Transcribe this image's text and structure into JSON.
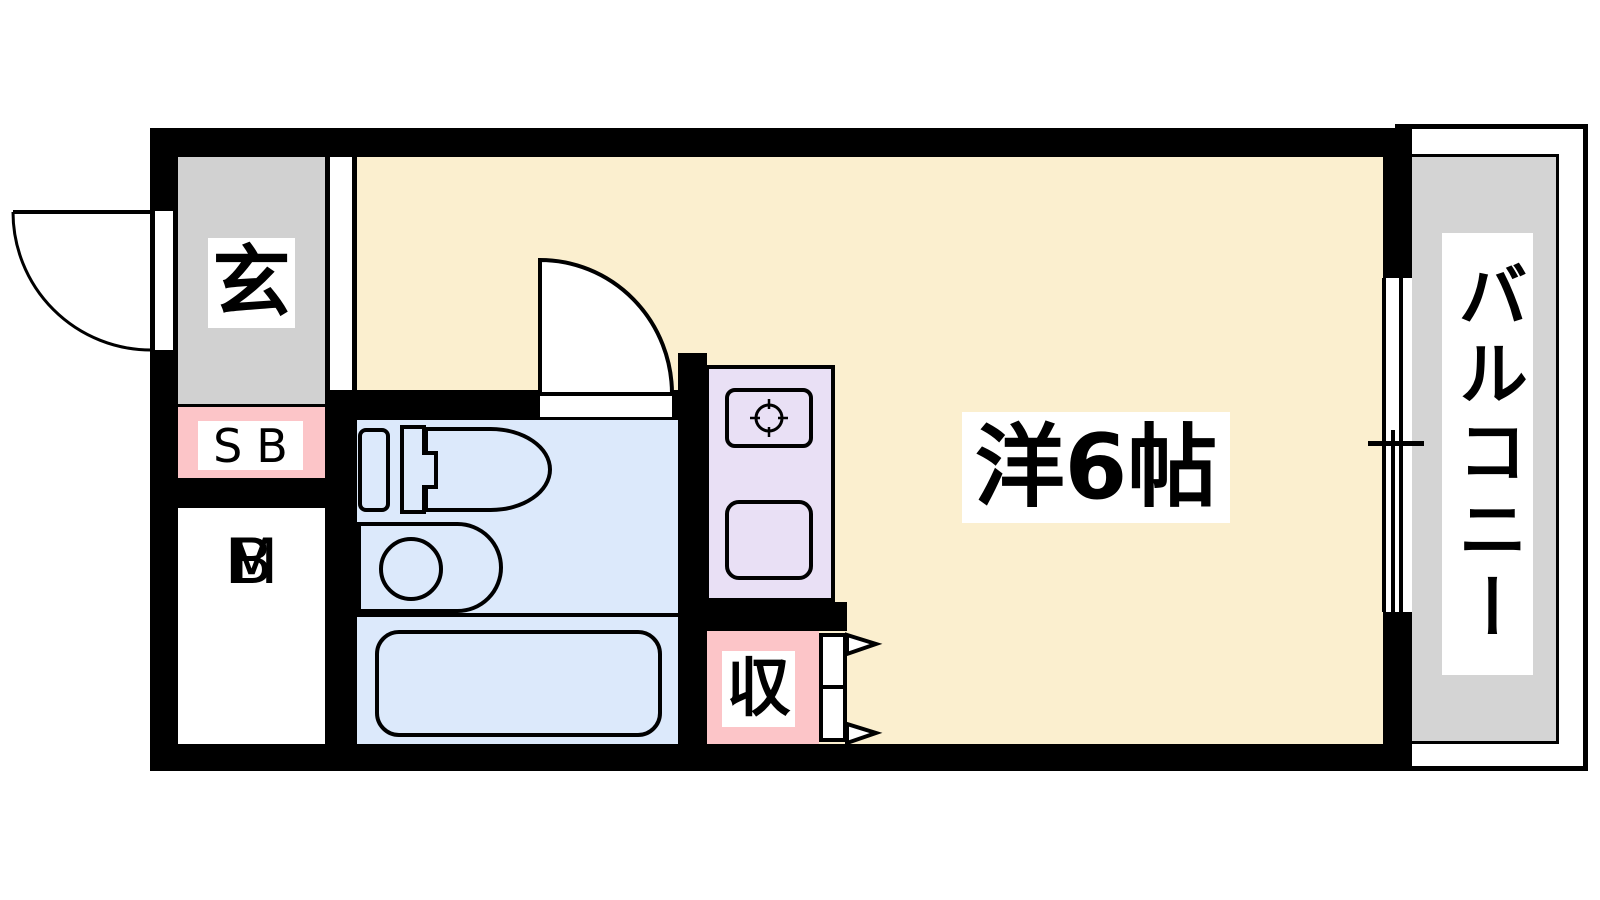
{
  "floorplan": {
    "labels": {
      "entrance": "玄",
      "shoe_box": "SB",
      "meter_box_line1": "M",
      "meter_box_line2": "B",
      "storage": "収",
      "main_room": "洋6帖",
      "balcony": "バルコニー"
    },
    "colors": {
      "wall": "#000000",
      "room_floor": "#FBEFCF",
      "entrance_floor": "#D1D1D1",
      "balcony_floor": "#D4D4D4",
      "bathroom_floor": "#DCE9FB",
      "kitchen_counter": "#E9E0F5",
      "accent_pink": "#FCC5C8",
      "label_background": "#FFFFFF",
      "label_text": "#000000"
    }
  }
}
